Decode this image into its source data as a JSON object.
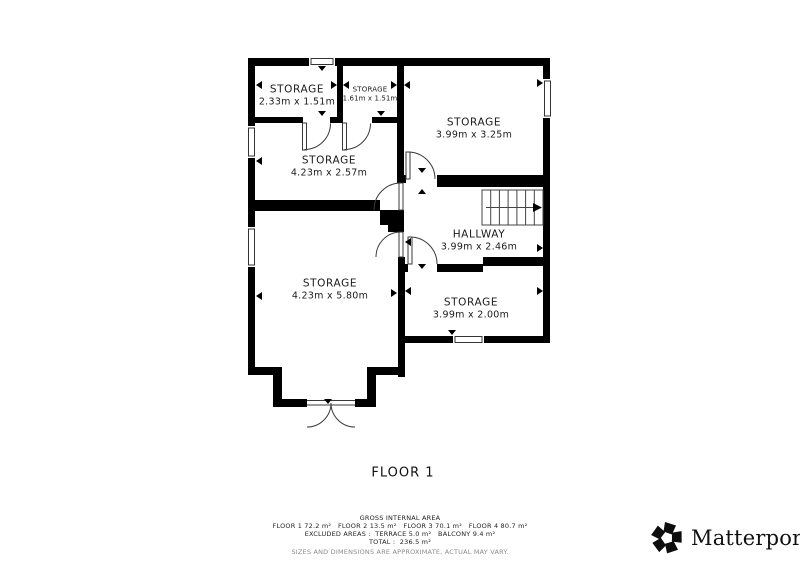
{
  "floor_label": "FLOOR 1",
  "rooms": [
    {
      "name": "STORAGE",
      "dims": "2.33m x 1.51m"
    },
    {
      "name": "STORAGE",
      "dims": "1.61m x 1.51m"
    },
    {
      "name": "STORAGE",
      "dims": "4.23m x 2.57m"
    },
    {
      "name": "STORAGE",
      "dims": "3.99m x 3.25m"
    },
    {
      "name": "HALLWAY",
      "dims": "3.99m x 2.46m"
    },
    {
      "name": "STORAGE",
      "dims": "3.99m x 2.00m"
    },
    {
      "name": "STORAGE",
      "dims": "4.23m x 5.80m"
    }
  ],
  "footer": {
    "title": "GROSS INTERNAL AREA",
    "areas_line": "FLOOR 1 72.2 m²   FLOOR 2 13.5 m²   FLOOR 3 70.1 m²   FLOOR 4 80.7 m²",
    "excluded_line": "EXCLUDED AREAS :  TERRACE 5.0 m²   BALCONY 9.4 m²",
    "total_line": "TOTAL :  236.5 m²",
    "disclaimer": "SIZES AND DIMENSIONS ARE APPROXIMATE, ACTUAL MAY VARY."
  },
  "branding": {
    "logo_text": "Matterport",
    "trademark": "™"
  },
  "colors": {
    "wall": "#000000",
    "background": "#ffffff",
    "label_text": "#1b1b1b",
    "disclaimer_gray": "#8c8c8c"
  }
}
